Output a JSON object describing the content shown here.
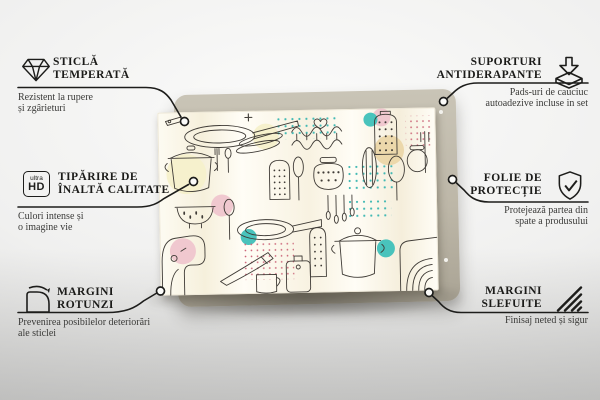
{
  "colors": {
    "line": "#1d1d1b",
    "accent_teal": "#49c3bc",
    "accent_pink": "#f0c8cf",
    "accent_beige": "#ecd8ab",
    "backdrop_tan": "#bdb7a8"
  },
  "product": {
    "type_name": "kitchen-doodle-pattern-glass-board"
  },
  "callouts": {
    "left": [
      {
        "id": "tempered-glass",
        "icon": "diamond-icon",
        "title": [
          "STICLĂ",
          "TEMPERATĂ"
        ],
        "subtitle": [
          "Rezistent la rupere",
          "și zgârieturi"
        ]
      },
      {
        "id": "hd-print",
        "icon": "ultra-hd-icon",
        "icon_text": {
          "small": "ultra",
          "big": "HD"
        },
        "title": [
          "TIPĂRIRE DE",
          "ÎNALTĂ CALITATE"
        ],
        "subtitle": [
          "Culori intense și",
          "o imagine vie"
        ]
      },
      {
        "id": "rounded-edges",
        "icon": "rounded-corner-icon",
        "title": [
          "MARGINI",
          "ROTUNZI"
        ],
        "subtitle": [
          "Prevenirea posibilelor deteriorări",
          "ale sticlei"
        ]
      }
    ],
    "right": [
      {
        "id": "anti-slip-pads",
        "icon": "anti-slip-pad-icon",
        "title": [
          "SUPORTURI",
          "ANTIDERAPANTE"
        ],
        "subtitle": [
          "Pads-uri de cauciuc",
          "autoadezive incluse in set"
        ]
      },
      {
        "id": "protective-film",
        "icon": "shield-check-icon",
        "title": [
          "FOLIE DE",
          "PROTECȚIE"
        ],
        "subtitle": [
          "Protejează partea din",
          "spate a produsului"
        ]
      },
      {
        "id": "polished-edges",
        "icon": "polished-edge-icon",
        "title": [
          "MARGINI",
          "SLEFUITE"
        ],
        "subtitle": [
          "Finisaj neted și sigur"
        ]
      }
    ]
  }
}
